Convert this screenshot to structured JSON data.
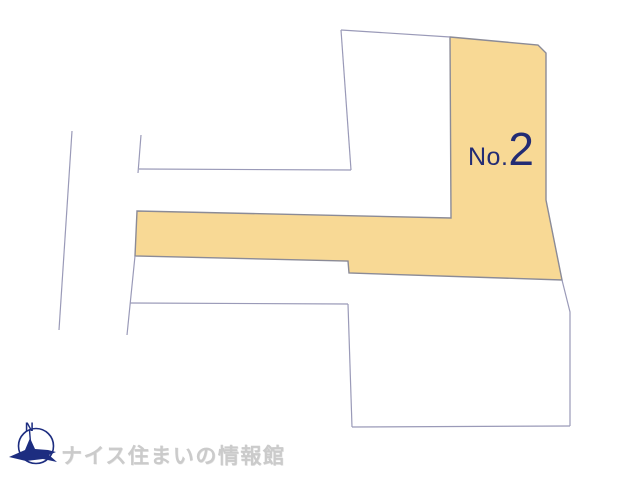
{
  "plot_map": {
    "featured_parcel": {
      "label_prefix": "No.",
      "label_number": "2",
      "fill_color": "#f8d995",
      "stroke_color": "#8b8b97",
      "points": "450,37 538,45 546,53 546,200 562,280 349,273 348,261 135,256 137,211 451,218"
    },
    "boundary_color": "#9a9ab8",
    "boundaries": [
      {
        "id": "upper-parcel-north-edge",
        "points": "341,30 450,37"
      },
      {
        "id": "upper-parcel-west-edge",
        "points": "341,30 351,170"
      },
      {
        "id": "mid-horizontal-boundary",
        "points": "139,169 351,170"
      },
      {
        "id": "upper-left-stub-boundary",
        "points": "141,135 138,173"
      },
      {
        "id": "far-west-boundary",
        "points": "72,131 59,330"
      },
      {
        "id": "lower-left-stub-boundary",
        "points": "135,256 127,335"
      },
      {
        "id": "lower-parcel-north-edge",
        "points": "130,303 348,304"
      },
      {
        "id": "lower-parcel-west-edge",
        "points": "348,304 352,427"
      },
      {
        "id": "lower-parcel-south-edge",
        "points": "352,427 570,426"
      },
      {
        "id": "lower-parcel-east-edge",
        "points": "562,280 570,312 570,426"
      }
    ]
  },
  "footer": {
    "logo": {
      "icon": "compass-bird-icon",
      "compass_letter": "N",
      "icon_color": "#1d2d80",
      "brand_text": "ナイス住まいの情報館",
      "text_color": "#cbcbcb"
    }
  }
}
